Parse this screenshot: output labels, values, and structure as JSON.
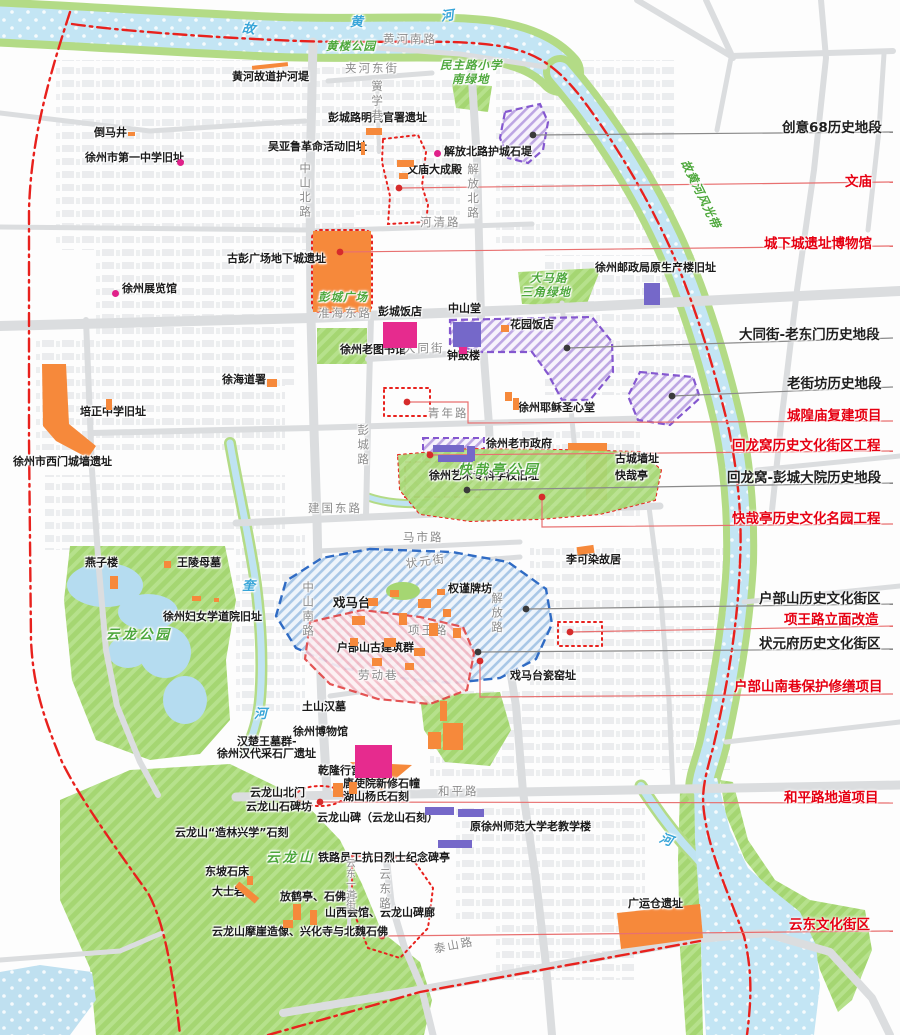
{
  "map_name": "徐州历史文化街区与文物古迹分布图",
  "colors": {
    "site_orange": "#f6893b",
    "historic_pink": "#e62b8e",
    "historic_purple": "#7568c9",
    "district_purple_border": "#8457cf",
    "district_blue_border": "#2f6bc4",
    "district_red_border": "#e24646",
    "boundary_red": "#e8211d",
    "label_red": "#e60012",
    "label_black": "#1f1f1f",
    "road_gray": "#dbdddf",
    "water_blue": "#c3e5f4",
    "park_green": "#a5d672"
  },
  "map": {
    "labels": [
      {
        "t": "黄河故道护河堤",
        "x": 232,
        "y": 71,
        "c": "site"
      },
      {
        "t": "倒马井",
        "x": 94,
        "y": 127,
        "c": "site"
      },
      {
        "t": "徐州市第一中学旧址",
        "x": 85,
        "y": 152,
        "c": "site"
      },
      {
        "t": "彭城路明代官署遗址",
        "x": 328,
        "y": 112,
        "c": "site"
      },
      {
        "t": "吴亚鲁革命活动旧址",
        "x": 268,
        "y": 141,
        "c": "site"
      },
      {
        "t": "解放北路护城石堤",
        "x": 444,
        "y": 146,
        "c": "site"
      },
      {
        "t": "文庙大成殿",
        "x": 407,
        "y": 164,
        "c": "site"
      },
      {
        "t": "古彭广场地下城遗址",
        "x": 227,
        "y": 253,
        "c": "site"
      },
      {
        "t": "徐州展览馆",
        "x": 122,
        "y": 283,
        "c": "site"
      },
      {
        "t": "彭城饭店",
        "x": 378,
        "y": 306,
        "c": "site"
      },
      {
        "t": "中山堂",
        "x": 448,
        "y": 303,
        "c": "site"
      },
      {
        "t": "花园饭店",
        "x": 510,
        "y": 319,
        "c": "site"
      },
      {
        "t": "钟鼓楼",
        "x": 447,
        "y": 350,
        "c": "site"
      },
      {
        "t": "徐州老图书馆",
        "x": 340,
        "y": 344,
        "c": "site"
      },
      {
        "t": "徐州邮政局原生产楼旧址",
        "x": 595,
        "y": 262,
        "c": "site"
      },
      {
        "t": "徐海道署",
        "x": 222,
        "y": 374,
        "c": "site"
      },
      {
        "t": "培正中学旧址",
        "x": 80,
        "y": 406,
        "c": "site"
      },
      {
        "t": "徐州市西门城墙遗址",
        "x": 13,
        "y": 456,
        "c": "site"
      },
      {
        "t": "徐州耶稣圣心堂",
        "x": 518,
        "y": 402,
        "c": "site"
      },
      {
        "t": "徐州老市政府",
        "x": 486,
        "y": 438,
        "c": "site"
      },
      {
        "t": "徐州艺术专科学校旧址",
        "x": 429,
        "y": 470,
        "c": "site"
      },
      {
        "t": "古城墙址",
        "x": 615,
        "y": 453,
        "c": "site"
      },
      {
        "t": "快哉亭",
        "x": 615,
        "y": 470,
        "c": "site"
      },
      {
        "t": "李可染故居",
        "x": 566,
        "y": 554,
        "c": "site"
      },
      {
        "t": "燕子楼",
        "x": 85,
        "y": 557,
        "c": "site"
      },
      {
        "t": "王陵母墓",
        "x": 177,
        "y": 557,
        "c": "site"
      },
      {
        "t": "徐州妇女学道院旧址",
        "x": 163,
        "y": 611,
        "c": "site"
      },
      {
        "t": "戏马台",
        "x": 333,
        "y": 596,
        "c": "site",
        "big": 1
      },
      {
        "t": "权谨牌坊",
        "x": 448,
        "y": 583,
        "c": "site"
      },
      {
        "t": "户部山古建筑群",
        "x": 337,
        "y": 642,
        "c": "site"
      },
      {
        "t": "戏马台瓷窑址",
        "x": 510,
        "y": 670,
        "c": "site"
      },
      {
        "t": "土山汉墓",
        "x": 302,
        "y": 701,
        "c": "site"
      },
      {
        "t": "徐州博物馆",
        "x": 293,
        "y": 726,
        "c": "site"
      },
      {
        "t": "汉楚王墓群-",
        "x": 237,
        "y": 736,
        "c": "site"
      },
      {
        "t": "徐州汉代采石厂遗址",
        "x": 217,
        "y": 748,
        "c": "site"
      },
      {
        "t": "乾隆行宫",
        "x": 318,
        "y": 765,
        "c": "site"
      },
      {
        "t": "唐使院新修石幢",
        "x": 343,
        "y": 778,
        "c": "site"
      },
      {
        "t": "湖山杨氏石刻",
        "x": 343,
        "y": 791,
        "c": "site"
      },
      {
        "t": "云龙山北门",
        "x": 250,
        "y": 787,
        "c": "site"
      },
      {
        "t": "云龙山石碑坊",
        "x": 246,
        "y": 801,
        "c": "site"
      },
      {
        "t": "云龙山碑（云龙山石刻）",
        "x": 317,
        "y": 812,
        "c": "site"
      },
      {
        "t": "云龙山“造林兴学”石刻",
        "x": 175,
        "y": 827,
        "c": "site"
      },
      {
        "t": "铁路员工抗日烈士纪念碑亭",
        "x": 318,
        "y": 852,
        "c": "site"
      },
      {
        "t": "东坡石床",
        "x": 205,
        "y": 866,
        "c": "site"
      },
      {
        "t": "大士岩",
        "x": 212,
        "y": 886,
        "c": "site"
      },
      {
        "t": "放鹤亭、石佛井",
        "x": 280,
        "y": 891,
        "c": "site"
      },
      {
        "t": "山西会馆、云龙山碑廊",
        "x": 325,
        "y": 907,
        "c": "site"
      },
      {
        "t": "云龙山摩崖造像、兴化寺与北魏石佛",
        "x": 212,
        "y": 926,
        "c": "site"
      },
      {
        "t": "原徐州师范大学老教学楼",
        "x": 470,
        "y": 821,
        "c": "site"
      },
      {
        "t": "广运仓遗址",
        "x": 628,
        "y": 898,
        "c": "site"
      },
      {
        "t": "黄河南路",
        "x": 383,
        "y": 33,
        "c": "road"
      },
      {
        "t": "夹河东街",
        "x": 345,
        "y": 62,
        "c": "road"
      },
      {
        "t": "黉学巷",
        "x": 371,
        "y": 80,
        "c": "road",
        "v": 1
      },
      {
        "t": "中山北路",
        "x": 299,
        "y": 162,
        "c": "road",
        "v": 1
      },
      {
        "t": "解放北路",
        "x": 467,
        "y": 163,
        "c": "road",
        "v": 1
      },
      {
        "t": "河清路",
        "x": 420,
        "y": 216,
        "c": "road"
      },
      {
        "t": "淮海东路",
        "x": 318,
        "y": 307,
        "c": "road"
      },
      {
        "t": "大同街",
        "x": 404,
        "y": 342,
        "c": "road"
      },
      {
        "t": "青年路",
        "x": 428,
        "y": 407,
        "c": "road"
      },
      {
        "t": "彭城路",
        "x": 357,
        "y": 424,
        "c": "road",
        "v": 1
      },
      {
        "t": "建国东路",
        "x": 308,
        "y": 502,
        "c": "road"
      },
      {
        "t": "马市路",
        "x": 403,
        "y": 531,
        "c": "road"
      },
      {
        "t": "状元街",
        "x": 405,
        "y": 558,
        "c": "road",
        "rot": -8
      },
      {
        "t": "中山南路",
        "x": 302,
        "y": 581,
        "c": "road",
        "v": 1
      },
      {
        "t": "解放路",
        "x": 491,
        "y": 592,
        "c": "road",
        "v": 1
      },
      {
        "t": "项王路",
        "x": 408,
        "y": 624,
        "c": "road"
      },
      {
        "t": "劳动巷",
        "x": 358,
        "y": 669,
        "c": "road"
      },
      {
        "t": "和平路",
        "x": 438,
        "y": 785,
        "c": "road"
      },
      {
        "t": "泰山路",
        "x": 433,
        "y": 943,
        "c": "road",
        "rot": -11
      },
      {
        "t": "云东路",
        "x": 379,
        "y": 868,
        "c": "road",
        "v": 1
      },
      {
        "t": "云东一道街",
        "x": 344,
        "y": 858,
        "c": "road",
        "v": 1,
        "sm": 1
      },
      {
        "t": "黄楼公园",
        "x": 326,
        "y": 40,
        "c": "park"
      },
      {
        "t": "民主路小学",
        "x": 440,
        "y": 59,
        "c": "park"
      },
      {
        "t": "南绿地",
        "x": 452,
        "y": 73,
        "c": "park"
      },
      {
        "t": "故黄河风光带",
        "x": 690,
        "y": 158,
        "c": "park",
        "rot": 64
      },
      {
        "t": "大马路",
        "x": 530,
        "y": 272,
        "c": "park"
      },
      {
        "t": "三角绿地",
        "x": 521,
        "y": 286,
        "c": "park"
      },
      {
        "t": "彭城广场",
        "x": 318,
        "y": 291,
        "c": "park"
      },
      {
        "t": "快哉亭公园",
        "x": 458,
        "y": 463,
        "c": "park",
        "big": 1
      },
      {
        "t": "云龙公园",
        "x": 106,
        "y": 628,
        "c": "park",
        "big": 1
      },
      {
        "t": "云龙山",
        "x": 266,
        "y": 851,
        "c": "park",
        "big": 1
      },
      {
        "t": "故",
        "x": 243,
        "y": 22,
        "c": "river",
        "rot": 8
      },
      {
        "t": "黄",
        "x": 350,
        "y": 16,
        "c": "river"
      },
      {
        "t": "河",
        "x": 440,
        "y": 11,
        "c": "river",
        "rot": -8
      },
      {
        "t": "奎",
        "x": 242,
        "y": 580,
        "c": "river"
      },
      {
        "t": "河",
        "x": 254,
        "y": 708,
        "c": "river"
      },
      {
        "t": "河",
        "x": 662,
        "y": 832,
        "c": "river",
        "rot": 20
      }
    ],
    "callouts": [
      {
        "t": "创意68历史地段",
        "c": "black",
        "x": 782,
        "y": 116,
        "dot": [
          533,
          135
        ],
        "line": [
          [
            533,
            135
          ],
          [
            893,
            132
          ]
        ]
      },
      {
        "t": "文庙",
        "c": "red",
        "x": 845,
        "y": 170,
        "dot": [
          399,
          188
        ],
        "line": [
          [
            399,
            188
          ],
          [
            893,
            182
          ]
        ]
      },
      {
        "t": "城下城遗址博物馆",
        "c": "red",
        "x": 764,
        "y": 232,
        "dot": [
          340,
          252
        ],
        "line": [
          [
            340,
            252
          ],
          [
            893,
            246
          ]
        ]
      },
      {
        "t": "大同街-老东门历史地段",
        "c": "black",
        "x": 739,
        "y": 323,
        "dot": [
          567,
          348
        ],
        "line": [
          [
            567,
            348
          ],
          [
            893,
            338
          ]
        ]
      },
      {
        "t": "老街坊历史地段",
        "c": "black",
        "x": 787,
        "y": 372,
        "dot": [
          672,
          396
        ],
        "line": [
          [
            672,
            396
          ],
          [
            893,
            387
          ]
        ]
      },
      {
        "t": "城隍庙复建项目",
        "c": "red",
        "x": 787,
        "y": 404,
        "dot": [
          407,
          402
        ],
        "line": [
          [
            407,
            402
          ],
          [
            468,
            402
          ],
          [
            468,
            423
          ],
          [
            893,
            421
          ]
        ]
      },
      {
        "t": "回龙窝历史文化街区工程",
        "c": "red",
        "x": 732,
        "y": 434,
        "dot": [
          430,
          455
        ],
        "line": [
          [
            430,
            455
          ],
          [
            893,
            451
          ]
        ]
      },
      {
        "t": "回龙窝-彭城大院历史地段",
        "c": "black",
        "x": 727,
        "y": 466,
        "dot": [
          467,
          490
        ],
        "line": [
          [
            467,
            490
          ],
          [
            893,
            483
          ]
        ]
      },
      {
        "t": "快哉亭历史文化名园工程",
        "c": "red",
        "x": 732,
        "y": 507,
        "dot": [
          542,
          497
        ],
        "line": [
          [
            542,
            497
          ],
          [
            542,
            527
          ],
          [
            893,
            524
          ]
        ]
      },
      {
        "t": "户部山历史文化街区",
        "c": "black",
        "x": 759,
        "y": 587,
        "dot": [
          526,
          609
        ],
        "line": [
          [
            526,
            609
          ],
          [
            893,
            604
          ]
        ]
      },
      {
        "t": "项王路立面改造",
        "c": "red",
        "x": 784,
        "y": 608,
        "dot": [
          570,
          632
        ],
        "line": [
          [
            570,
            632
          ],
          [
            893,
            626
          ]
        ]
      },
      {
        "t": "状元府历史文化街区",
        "c": "black",
        "x": 759,
        "y": 632,
        "dot": [
          478,
          652
        ],
        "line": [
          [
            478,
            652
          ],
          [
            893,
            649
          ]
        ]
      },
      {
        "t": "户部山南巷保护修缮项目",
        "c": "red",
        "x": 734,
        "y": 675,
        "dot": [
          480,
          661
        ],
        "line": [
          [
            480,
            661
          ],
          [
            480,
            697
          ],
          [
            893,
            694
          ]
        ]
      },
      {
        "t": "和平路地道项目",
        "c": "red",
        "x": 784,
        "y": 786,
        "dot": [
          320,
          802
        ],
        "line": [
          [
            320,
            802
          ],
          [
            893,
            803
          ]
        ]
      },
      {
        "t": "云东文化街区",
        "c": "red",
        "x": 789,
        "y": 913,
        "dot": [
          382,
          936
        ],
        "line": [
          [
            382,
            936
          ],
          [
            893,
            931
          ]
        ]
      }
    ],
    "markers": {
      "orange": [
        {
          "x": 252,
          "y": 64,
          "w": 36,
          "h": 4,
          "r": -6
        },
        {
          "x": 128,
          "y": 132,
          "w": 7,
          "h": 4
        },
        {
          "x": 366,
          "y": 128,
          "w": 16,
          "h": 7
        },
        {
          "x": 361,
          "y": 142,
          "w": 4,
          "h": 13
        },
        {
          "x": 397,
          "y": 160,
          "w": 17,
          "h": 7
        },
        {
          "x": 399,
          "y": 173,
          "w": 9,
          "h": 6
        },
        {
          "x": 501,
          "y": 325,
          "w": 8,
          "h": 7
        },
        {
          "x": 267,
          "y": 379,
          "w": 10,
          "h": 8
        },
        {
          "x": 106,
          "y": 399,
          "w": 6,
          "h": 11
        },
        {
          "x": 164,
          "y": 561,
          "w": 7,
          "h": 7
        },
        {
          "x": 110,
          "y": 576,
          "w": 8,
          "h": 13
        },
        {
          "x": 192,
          "y": 596,
          "w": 9,
          "h": 5
        },
        {
          "x": 214,
          "y": 598,
          "w": 5,
          "h": 4
        },
        {
          "x": 577,
          "y": 546,
          "w": 17,
          "h": 8,
          "r": -8
        },
        {
          "x": 505,
          "y": 392,
          "w": 7,
          "h": 9
        },
        {
          "x": 513,
          "y": 398,
          "w": 6,
          "h": 12
        },
        {
          "x": 352,
          "y": 616,
          "w": 13,
          "h": 9
        },
        {
          "x": 368,
          "y": 598,
          "w": 10,
          "h": 8
        },
        {
          "x": 384,
          "y": 638,
          "w": 12,
          "h": 9
        },
        {
          "x": 399,
          "y": 613,
          "w": 8,
          "h": 12
        },
        {
          "x": 418,
          "y": 599,
          "w": 13,
          "h": 9
        },
        {
          "x": 429,
          "y": 623,
          "w": 9,
          "h": 13
        },
        {
          "x": 443,
          "y": 609,
          "w": 8,
          "h": 8
        },
        {
          "x": 414,
          "y": 648,
          "w": 11,
          "h": 8
        },
        {
          "x": 372,
          "y": 658,
          "w": 10,
          "h": 8
        },
        {
          "x": 437,
          "y": 589,
          "w": 8,
          "h": 6
        },
        {
          "x": 453,
          "y": 628,
          "w": 8,
          "h": 10
        },
        {
          "x": 350,
          "y": 638,
          "w": 8,
          "h": 8
        },
        {
          "x": 390,
          "y": 590,
          "w": 9,
          "h": 7
        },
        {
          "x": 405,
          "y": 663,
          "w": 9,
          "h": 7
        },
        {
          "x": 440,
          "y": 701,
          "w": 7,
          "h": 20
        },
        {
          "x": 443,
          "y": 723,
          "w": 20,
          "h": 27
        },
        {
          "x": 428,
          "y": 732,
          "w": 13,
          "h": 17
        },
        {
          "x": 333,
          "y": 783,
          "w": 10,
          "h": 14
        },
        {
          "x": 349,
          "y": 782,
          "w": 8,
          "h": 12
        },
        {
          "x": 247,
          "y": 876,
          "w": 6,
          "h": 9
        },
        {
          "x": 234,
          "y": 889,
          "w": 26,
          "h": 7,
          "r": 40
        },
        {
          "x": 293,
          "y": 904,
          "w": 8,
          "h": 16
        },
        {
          "x": 310,
          "y": 910,
          "w": 7,
          "h": 15
        },
        {
          "x": 283,
          "y": 920,
          "w": 10,
          "h": 8
        }
      ],
      "pink": [
        {
          "x": 383,
          "y": 322,
          "w": 34,
          "h": 26
        },
        {
          "x": 355,
          "y": 745,
          "w": 37,
          "h": 33
        },
        {
          "x": 459,
          "y": 344,
          "w": 8,
          "h": 10
        }
      ],
      "purple": [
        {
          "x": 453,
          "y": 322,
          "w": 28,
          "h": 25
        },
        {
          "x": 644,
          "y": 283,
          "w": 16,
          "h": 22
        },
        {
          "x": 433,
          "y": 445,
          "w": 31,
          "h": 7
        },
        {
          "x": 438,
          "y": 455,
          "w": 35,
          "h": 7
        },
        {
          "x": 467,
          "y": 446,
          "w": 8,
          "h": 15
        },
        {
          "x": 425,
          "y": 807,
          "w": 29,
          "h": 8
        },
        {
          "x": 458,
          "y": 809,
          "w": 26,
          "h": 8
        },
        {
          "x": 438,
          "y": 840,
          "w": 34,
          "h": 8
        }
      ],
      "dots": {
        "magenta": [
          [
            437,
            153
          ],
          [
            115,
            293
          ],
          [
            180,
            162
          ]
        ]
      }
    }
  }
}
